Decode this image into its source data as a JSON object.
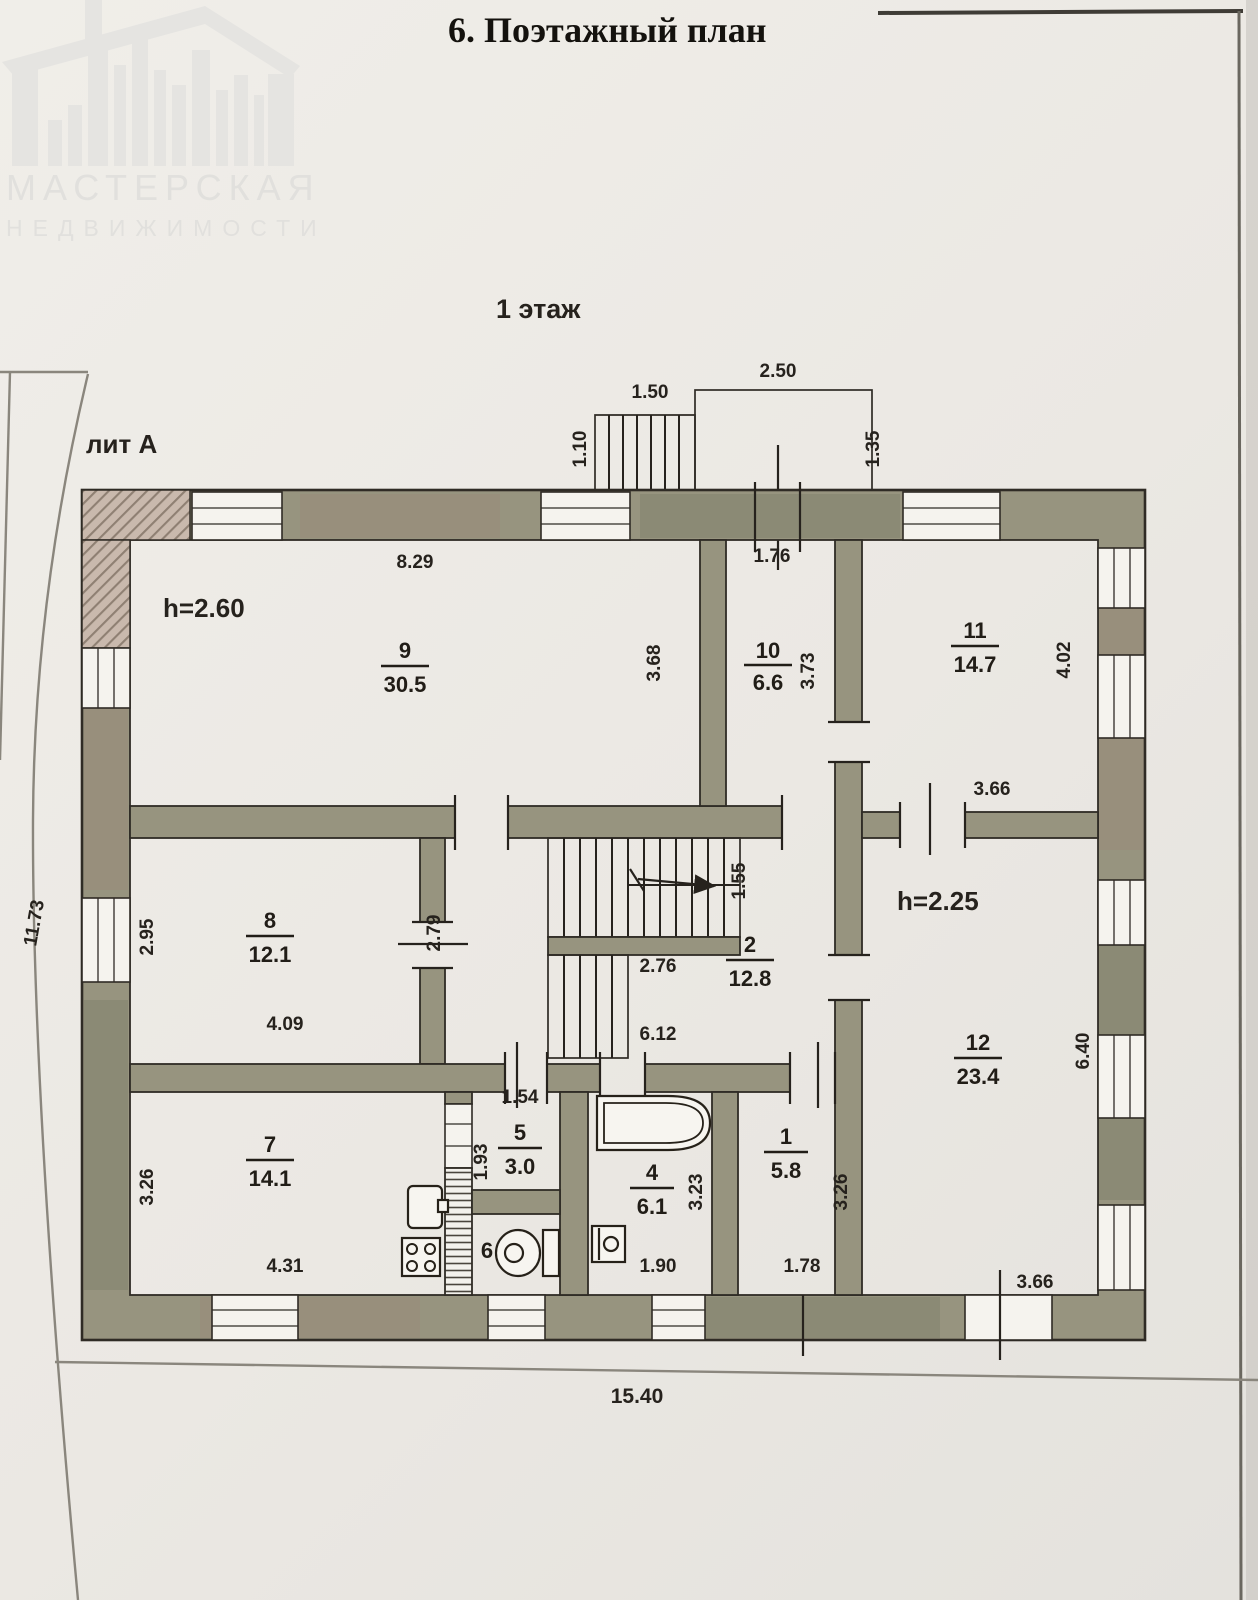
{
  "header": {
    "title": "6. Поэтажный план"
  },
  "watermark": {
    "line1": "МАСТЕРСКАЯ",
    "line2": "НЕДВИЖИМОСТИ"
  },
  "plan": {
    "floor_label": "1 этаж",
    "liter_label": "лит А",
    "height_left": "h=2.60",
    "height_right": "h=2.25",
    "rooms": {
      "r1": {
        "num": "1",
        "area": "5.8"
      },
      "r2": {
        "num": "2",
        "area": "12.8"
      },
      "r4": {
        "num": "4",
        "area": "6.1"
      },
      "r5": {
        "num": "5",
        "area": "3.0"
      },
      "r6": {
        "num": "6"
      },
      "r7": {
        "num": "7",
        "area": "14.1"
      },
      "r8": {
        "num": "8",
        "area": "12.1"
      },
      "r9": {
        "num": "9",
        "area": "30.5"
      },
      "r10": {
        "num": "10",
        "area": "6.6"
      },
      "r11": {
        "num": "11",
        "area": "14.7"
      },
      "r12": {
        "num": "12",
        "area": "23.4"
      }
    },
    "dims": {
      "porch_steps_width": "1.50",
      "porch_steps_depth": "1.10",
      "porch_width": "2.50",
      "porch_depth": "1.35",
      "room9_top": "8.29",
      "room9_right": "3.68",
      "room10_top": "1.76",
      "room10_right": "3.73",
      "room11_right": "4.02",
      "room11_bottom": "3.66",
      "room8_left": "2.95",
      "room8_bottom": "4.09",
      "hall_partition": "2.79",
      "stairs_landing": "1.55",
      "stairs_width": "2.76",
      "hall_bottom": "6.12",
      "room12_right": "6.40",
      "room12_bottom": "3.66",
      "room7_left": "3.26",
      "room7_bottom": "4.31",
      "room5_top": "1.54",
      "room5_left": "1.93",
      "room4_right": "3.23",
      "room4_bottom": "1.90",
      "room1_right": "3.26",
      "room1_bottom": "1.78",
      "building_bottom": "15.40",
      "building_left": "11.73"
    }
  }
}
